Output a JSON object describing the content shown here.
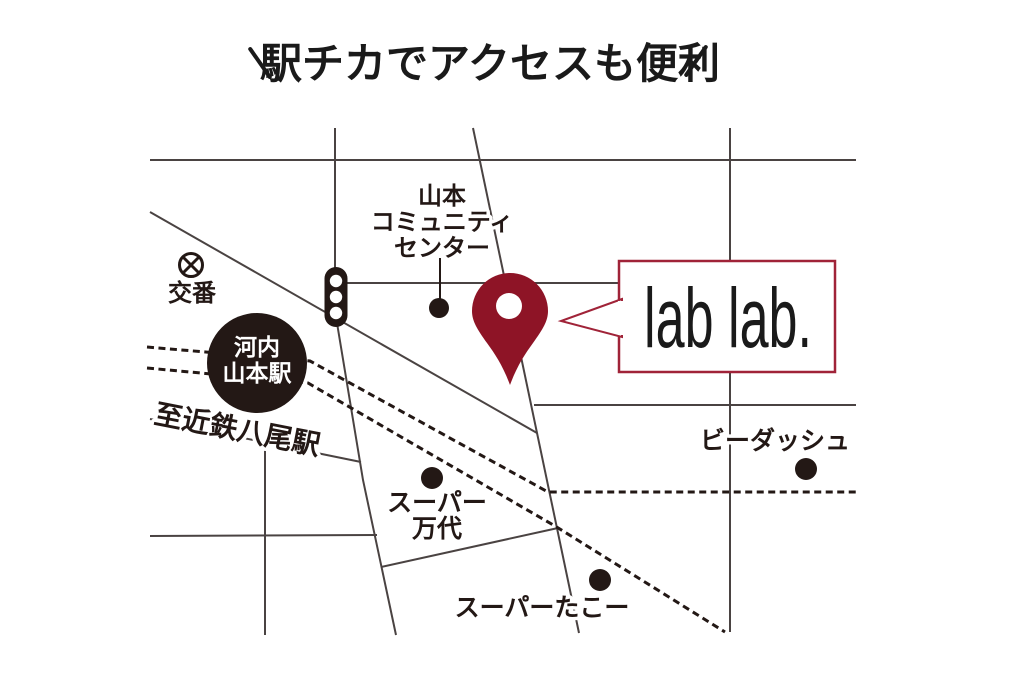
{
  "title": {
    "text": "駅チカでアクセスも便利"
  },
  "callout": {
    "label": "lab lab."
  },
  "map": {
    "labels": {
      "station": {
        "lines": [
          "河内",
          "山本駅"
        ]
      },
      "koban": "交番",
      "community": {
        "lines": [
          "山本",
          "コミュニティ",
          "センター"
        ]
      },
      "to_yao": "至近鉄八尾駅",
      "b_dash": "ビーダッシュ",
      "mandai": {
        "lines": [
          "スーパー",
          "万代"
        ]
      },
      "tako": "スーパーたこー"
    }
  },
  "colors": {
    "pin": "#8e1426",
    "callout_border": "#a02338",
    "road": "#4a4342",
    "ink": "#231815",
    "text": "#231815",
    "station_text": "#ffffff"
  }
}
